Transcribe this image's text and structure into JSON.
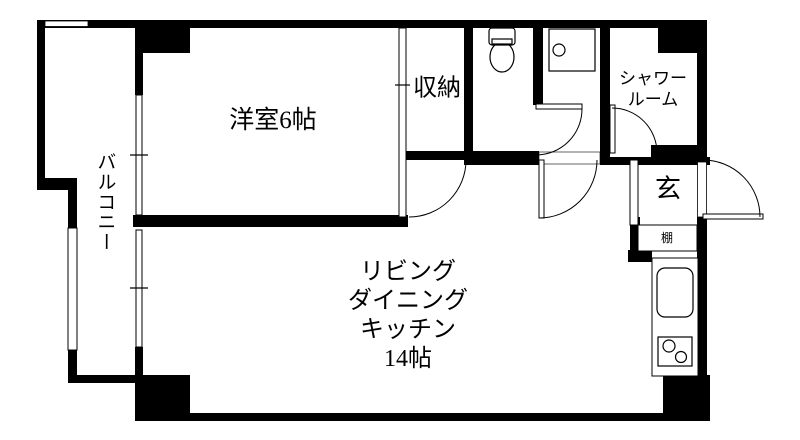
{
  "floorplan": {
    "type": "japanese-apartment-floorplan",
    "colors": {
      "wall": "#000000",
      "background": "#ffffff",
      "line": "#000000"
    },
    "rooms": {
      "western_room": {
        "label": "洋室6帖"
      },
      "balcony": {
        "label": "バルコニー"
      },
      "storage": {
        "label": "収納"
      },
      "shower_room": {
        "label_line1": "シャワー",
        "label_line2": "ルーム"
      },
      "entrance": {
        "label": "玄"
      },
      "shelf": {
        "label": "棚"
      },
      "ldk": {
        "label_line1": "リビング",
        "label_line2": "ダイニング",
        "label_line3": "キッチン",
        "label_line4": "14帖"
      }
    },
    "fixtures": [
      "toilet-icon",
      "washbasin-icon",
      "kitchen-sink-icon",
      "stove-icon",
      "door-swing-arcs",
      "window-double-lines"
    ]
  }
}
